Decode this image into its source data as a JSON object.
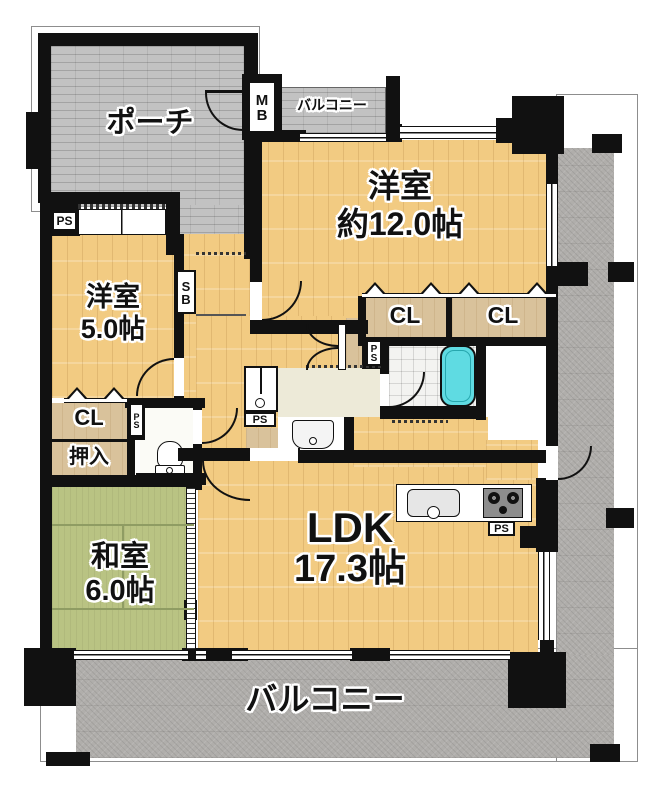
{
  "labels": {
    "porch": "ポーチ",
    "balcony": "バルコニー",
    "mb": "MB",
    "sb": "SB",
    "ps": "PS",
    "cl": "CL",
    "oshiire": "押入"
  },
  "rooms": {
    "r12": {
      "name": "洋室",
      "size": "約12.0帖"
    },
    "r5": {
      "name": "洋室",
      "size": "5.0帖"
    },
    "washitsu": {
      "name": "和室",
      "size": "6.0帖"
    },
    "ldk": {
      "name": "LDK",
      "size": "17.3帖"
    }
  },
  "colors": {
    "wall": "#111111",
    "wood_floor": "#f2cb82",
    "tatami": "#b9c383",
    "porch_tile": "#c2c2c2",
    "balcony": "#b0aeab",
    "bathtub": "#5fdbe2",
    "closet": "#d9c29b",
    "washroom": "#edead8"
  }
}
